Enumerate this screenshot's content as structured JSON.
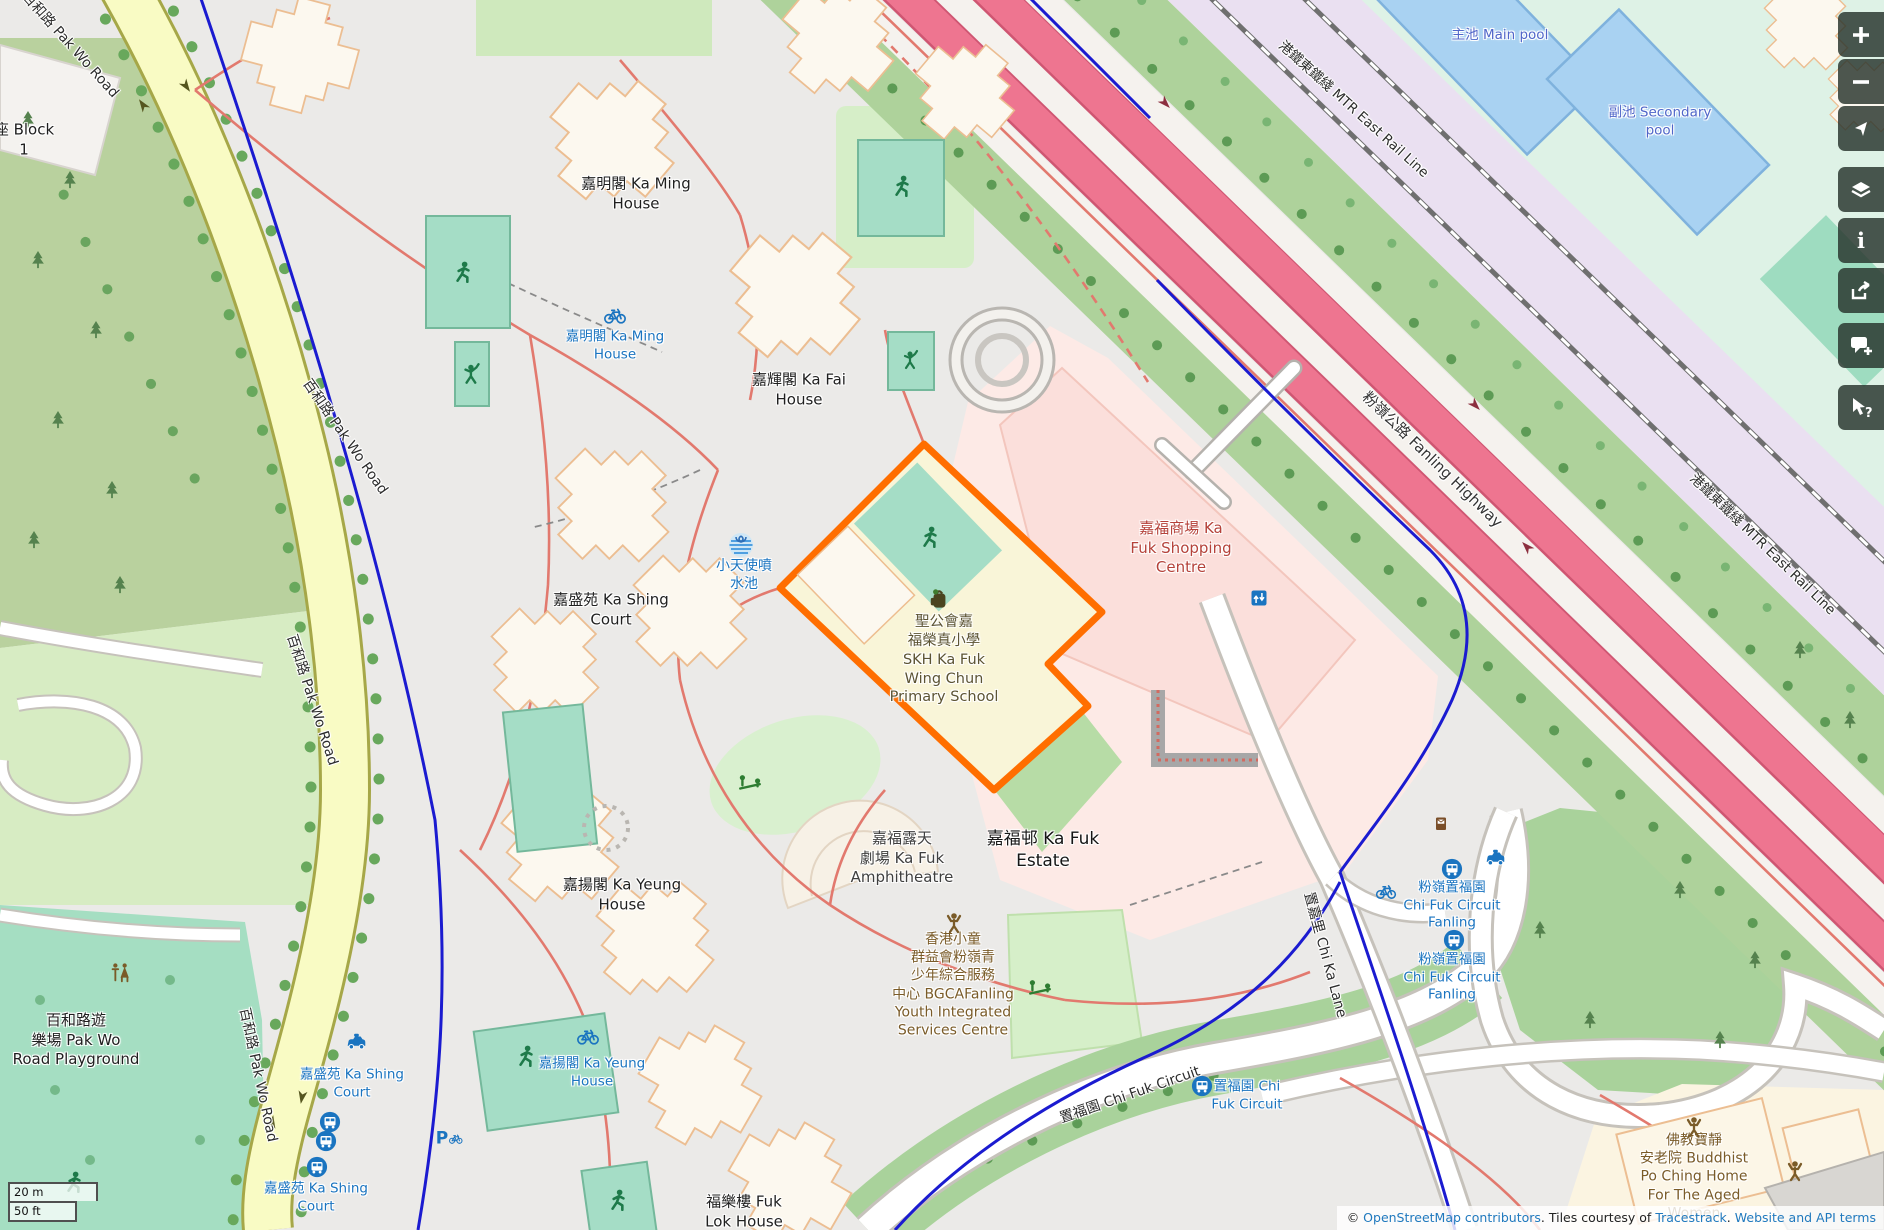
{
  "map_labels": {
    "block1": "座 Block\n1",
    "ka_ming_house": "嘉明閣 Ka Ming\nHouse",
    "ka_ming_house_cycle": "嘉明閣 Ka Ming\nHouse",
    "ka_fai_house": "嘉輝閣 Ka Fai\nHouse",
    "ka_shing_court": "嘉盛苑 Ka Shing\nCourt",
    "fountain": "小天使噴\n水池",
    "school": "聖公會嘉\n福榮真小學\nSKH Ka Fuk\nWing Chun\nPrimary School",
    "shopping_centre": "嘉福商場 Ka\nFuk Shopping\nCentre",
    "amphitheatre": "嘉福露天\n劇場 Ka Fuk\nAmphitheatre",
    "ka_fuk_estate": "嘉福邨 Ka Fuk\nEstate",
    "bgca": "香港小童\n群益會粉嶺青\n少年綜合服務\n中心 BGCAFanling\nYouth Integrated\nServices Centre",
    "buddhist_home": "佛教寶靜\n安老院 Buddhist\nPo Ching Home\nFor The Aged\nWomen",
    "main_pool": "主池 Main pool",
    "secondary_pool": "副池 Secondary\npool",
    "playground": "百和路遊\n樂場 Pak Wo\nRoad Playground",
    "ka_yeung_house": "嘉揚閣 Ka Yeung\nHouse",
    "ka_yeung_house_cycle": "嘉揚閣 Ka Yeung\nHouse",
    "fuk_lok_house": "福樂樓 Fuk\nLok House",
    "ka_shing_stop_taxi": "嘉盛苑 Ka Shing\nCourt",
    "ka_shing_stop_bus": "嘉盛苑 Ka Shing\nCourt",
    "chi_fuk_stop_1": "粉嶺置福園\nChi Fuk Circuit\nFanling",
    "chi_fuk_stop_2": "粉嶺置福園\nChi Fuk Circuit\nFanling",
    "chi_fuk_stop_3": "置福園 Chi\nFuk Circuit"
  },
  "roads": {
    "pak_wo_road": "百和路 Pak Wo Road",
    "fanling_highway": "粉嶺公路 Fanling Highway",
    "mtr_east_rail": "港鐵東鐵綫 MTR East Rail Line",
    "chi_ka_lane": "置嘉里 Chi Ka Lane",
    "chi_fuk_circuit": "置福園 Chi Fuk Circuit"
  },
  "controls": {
    "zoom_in": "Zoom in",
    "zoom_out": "Zoom out",
    "locate": "Show my location",
    "layers": "Layers",
    "info": "Map information",
    "info_glyph": "i",
    "share": "Share",
    "note": "Add a note to the map",
    "query": "Query features",
    "query_glyph": "?"
  },
  "icons": {
    "parking_glyph": "P"
  },
  "scalebar": {
    "metric": "20 m",
    "imperial": "50 ft"
  },
  "attribution": {
    "copyright": "© ",
    "osm_link": "OpenStreetMap contributors",
    "middle": ". Tiles courtesy of ",
    "tracestrack_link": "Tracestrack",
    "separator": ". ",
    "terms_link": "Website and API terms"
  },
  "colors": {
    "selection_orange": "#ff6e00",
    "highway_pink": "#ee7590",
    "transit_blue": "#1a74c0",
    "cycle_blue": "#1b1bd0",
    "school_yellow": "#f9f5d8",
    "retail_pink": "#fbdfdb",
    "pitch_teal": "#a5ddc6"
  }
}
